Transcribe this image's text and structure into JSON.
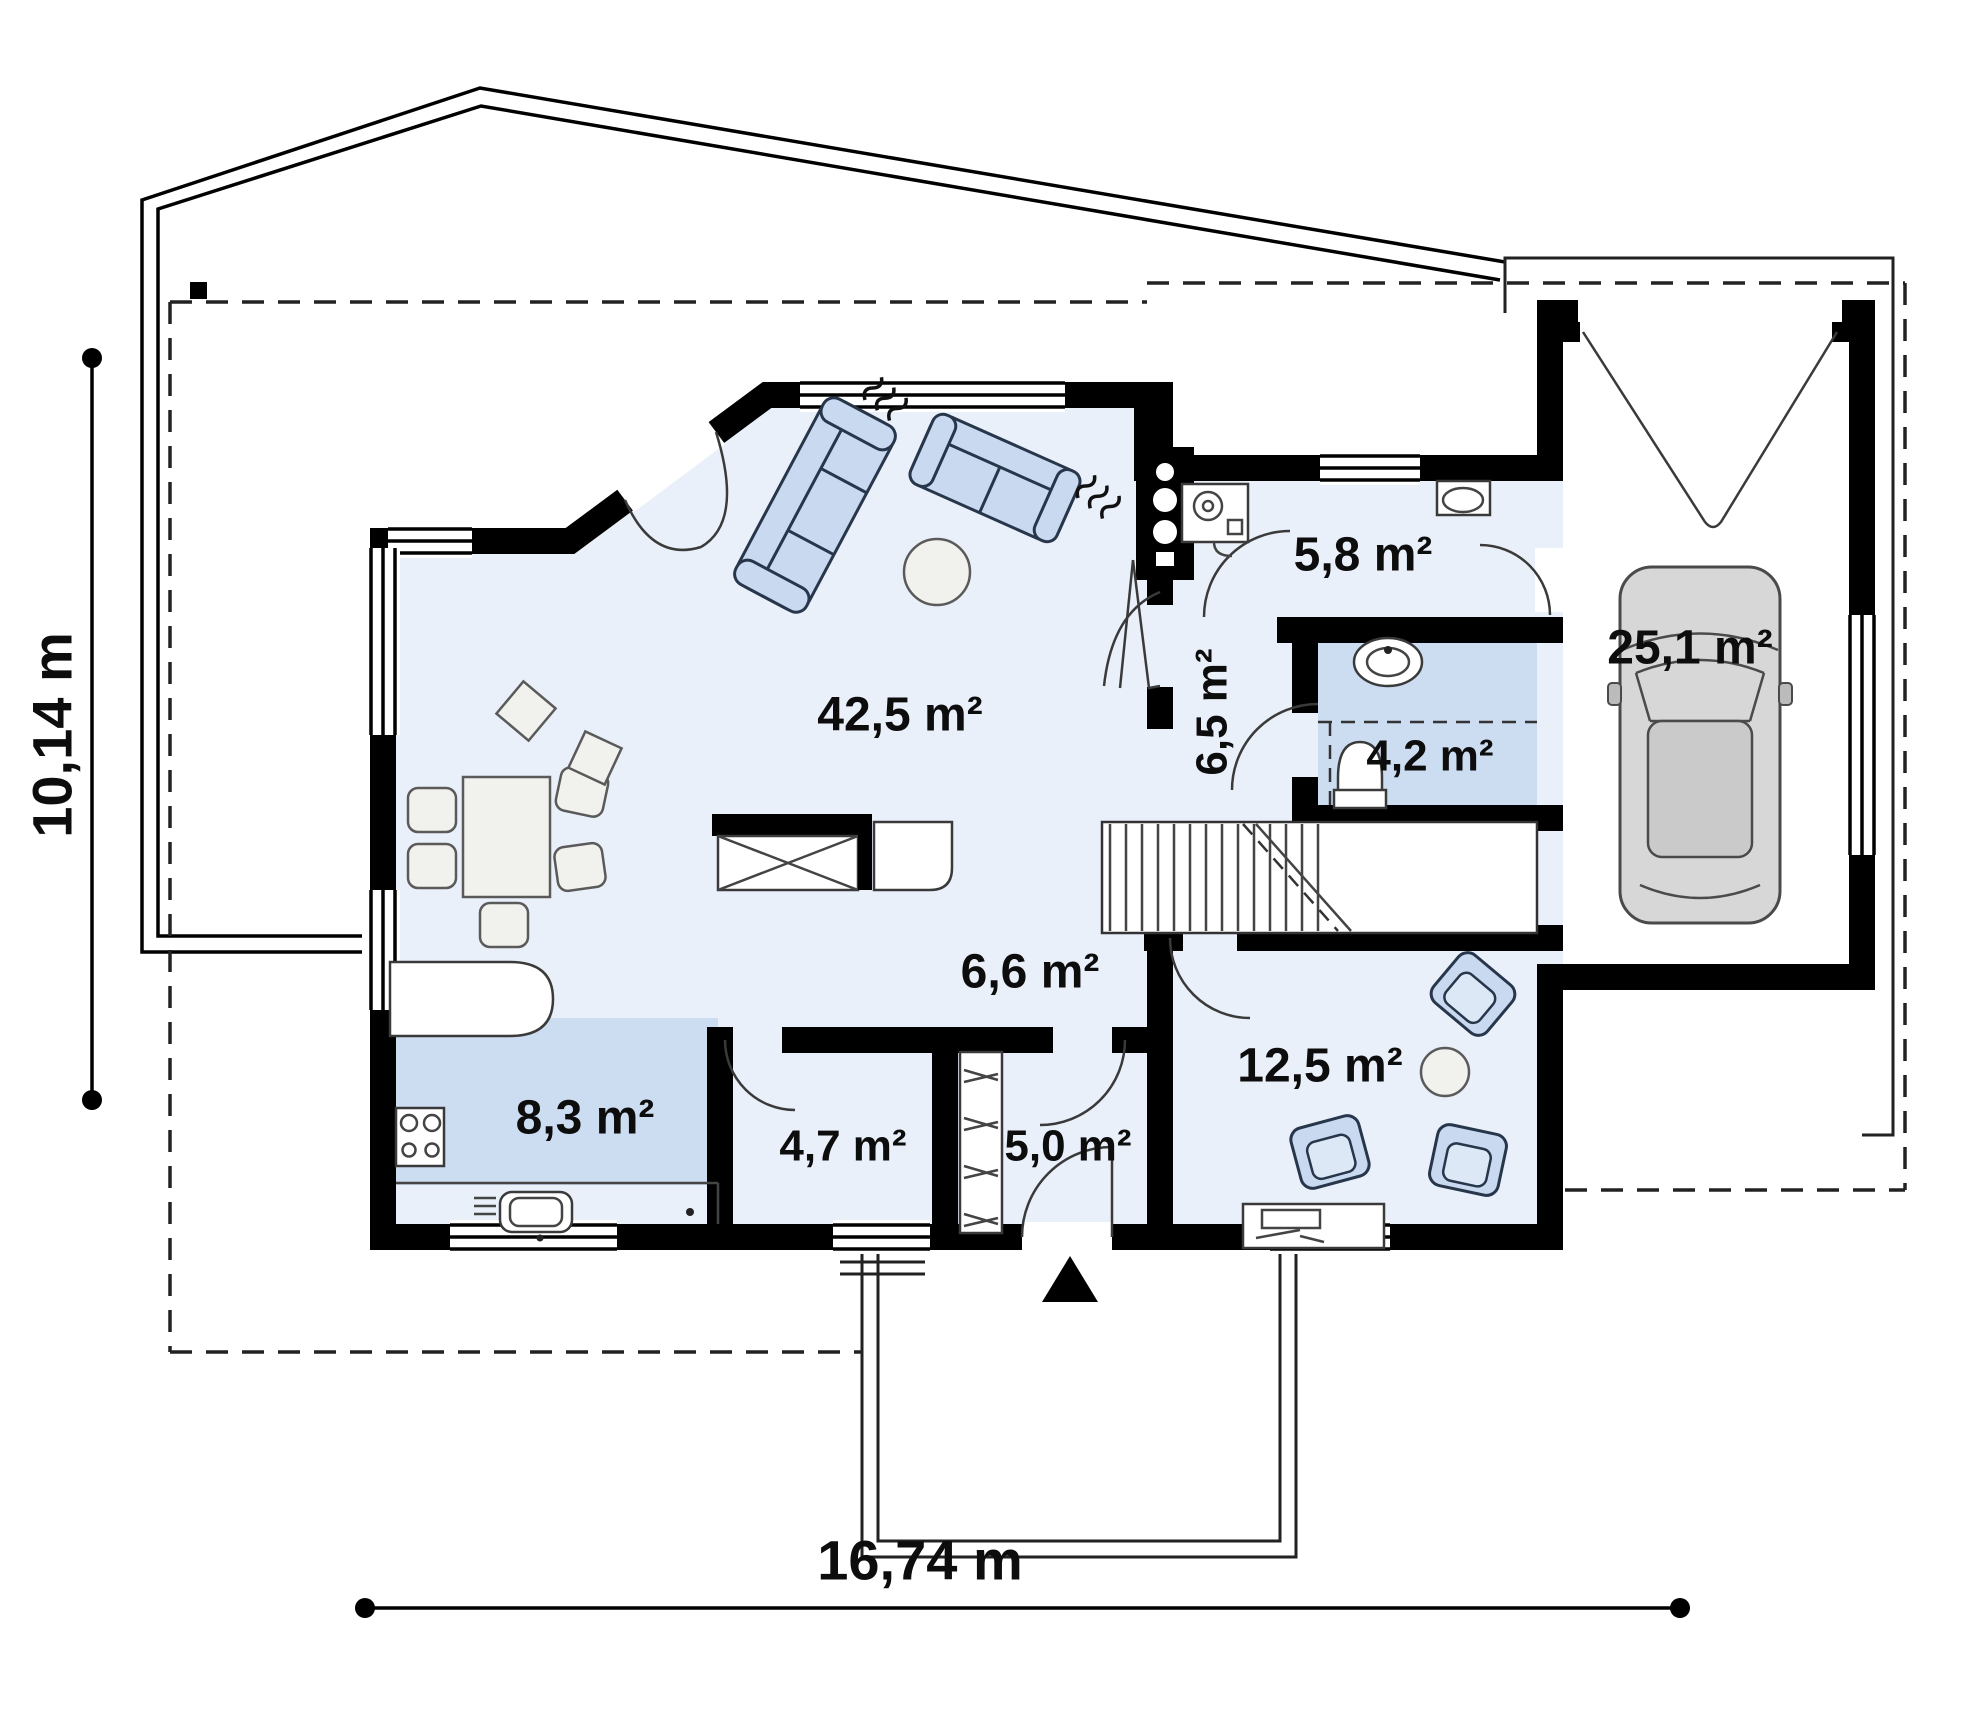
{
  "plan": {
    "type": "floor-plan",
    "rooms": [
      {
        "id": "living-room",
        "area": "42,5 m²"
      },
      {
        "id": "utility-room",
        "area": "5,8 m²"
      },
      {
        "id": "corridor",
        "area": "6,5 m²"
      },
      {
        "id": "bathroom",
        "area": "4,2 m²"
      },
      {
        "id": "garage",
        "area": "25,1 m²"
      },
      {
        "id": "hall",
        "area": "6,6 m²"
      },
      {
        "id": "kitchen",
        "area": "8,3 m²"
      },
      {
        "id": "pantry",
        "area": "4,7 m²"
      },
      {
        "id": "vestibule",
        "area": "5,0 m²"
      },
      {
        "id": "office",
        "area": "12,5 m²"
      }
    ],
    "dimensions": {
      "height": "10,14 m",
      "width": "16,74 m"
    },
    "colors": {
      "wall": "#000000",
      "floor": "#eaf0fa",
      "shaded_floor": "#ccddf1",
      "furniture": "#c9daf0",
      "car": "#d7d7d7"
    }
  }
}
